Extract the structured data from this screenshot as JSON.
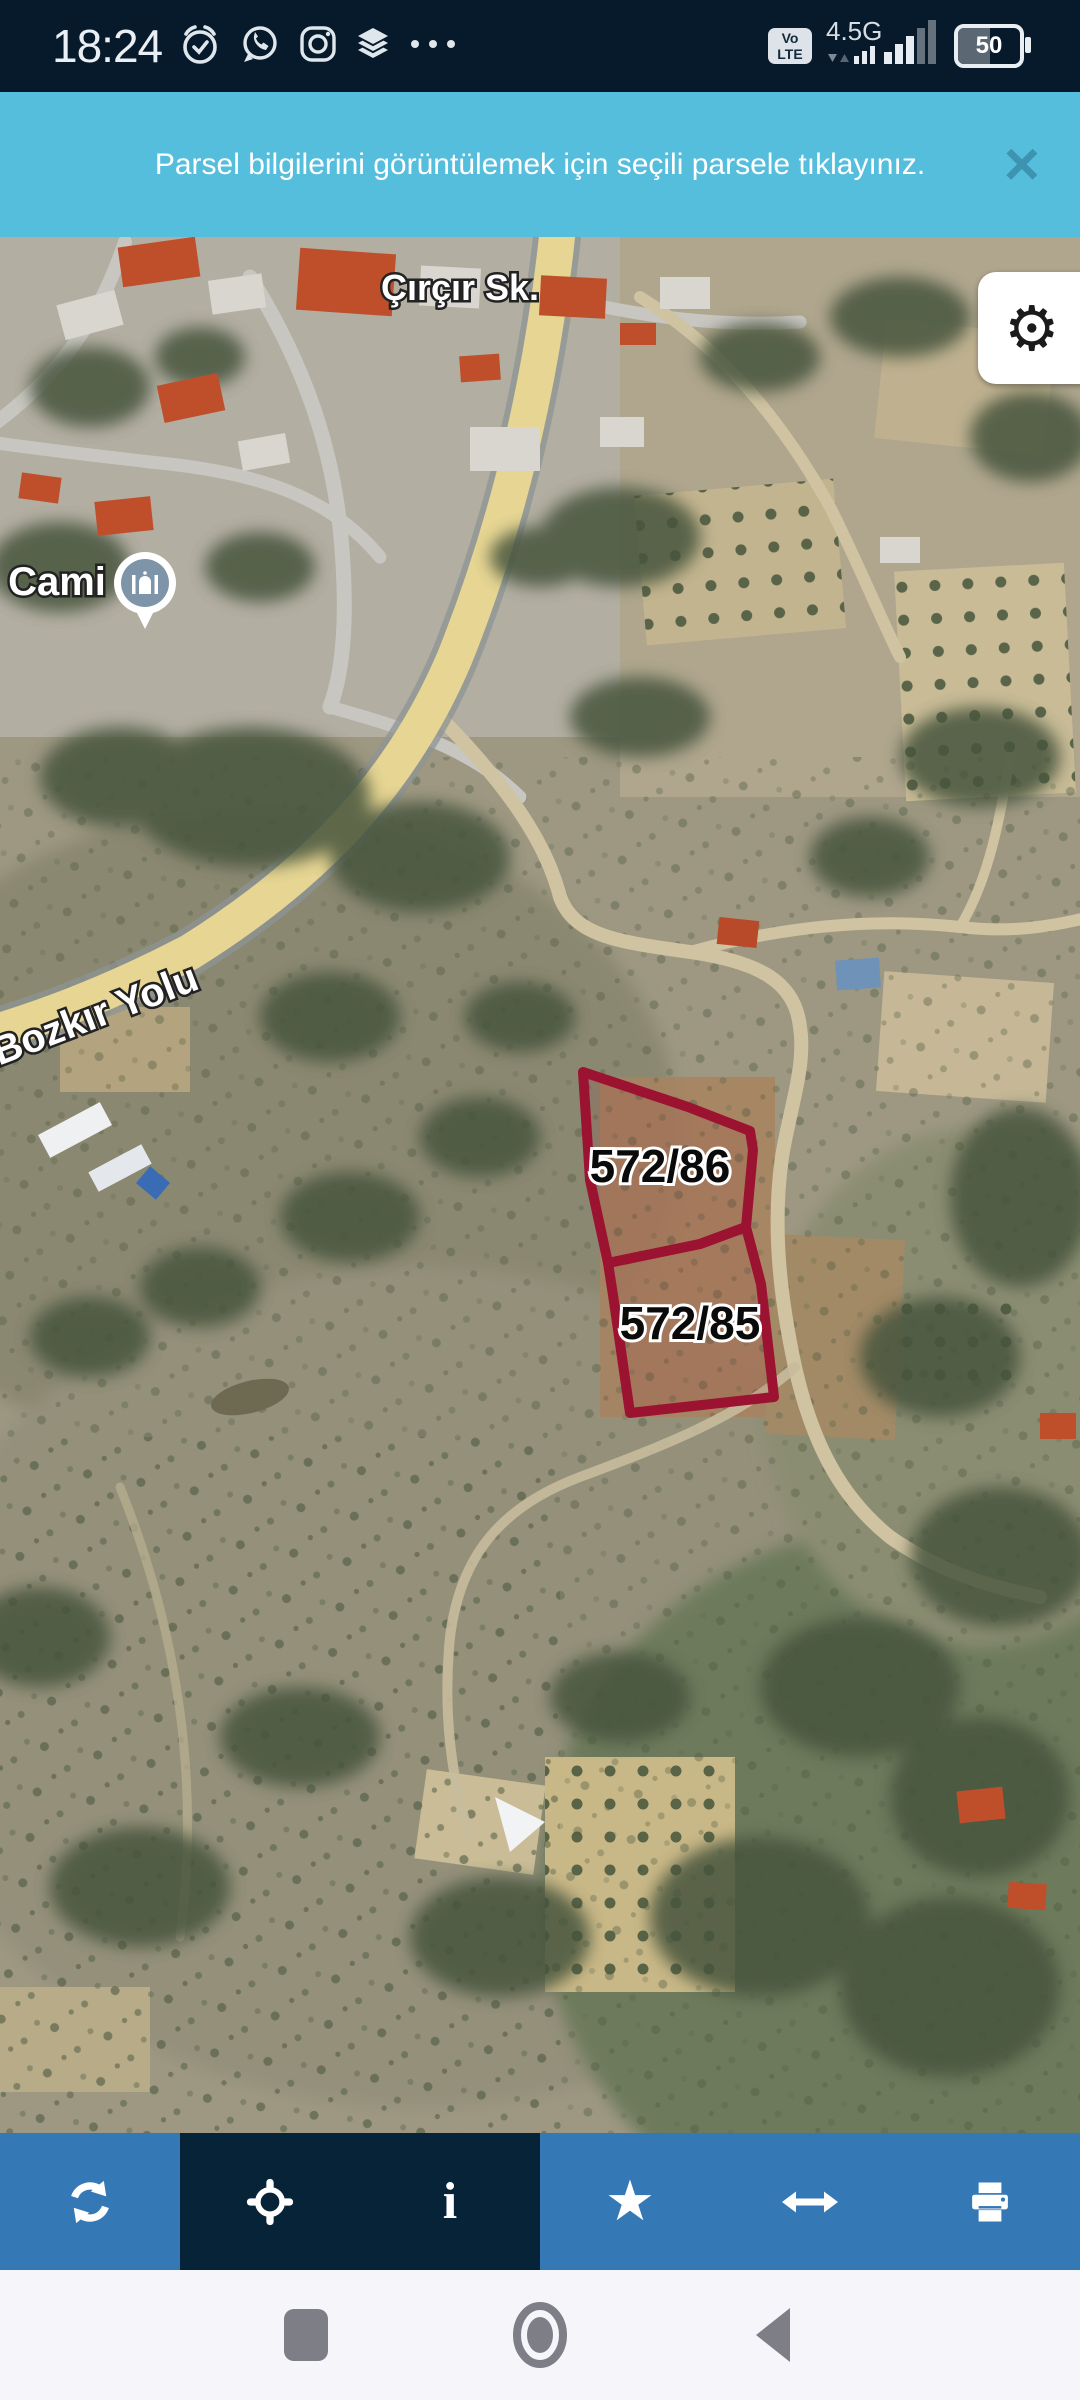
{
  "status_bar": {
    "time": "18:24",
    "left_icons": [
      "alarm",
      "whatsapp",
      "instagram",
      "layers",
      "more"
    ],
    "volte_line1": "Vo",
    "volte_line2": "LTE",
    "network_type": "4.5G",
    "battery_percent": "50"
  },
  "banner": {
    "message": "Parsel bilgilerini görüntülemek için seçili parsele tıklayınız.",
    "close_glyph": "×"
  },
  "map": {
    "street_label": "Çırçır Sk.",
    "poi_label": "Cami",
    "road_label": "Bozkır Yolu",
    "parcels": [
      {
        "id": "572/86"
      },
      {
        "id": "572/85"
      }
    ],
    "settings_glyph": "⚙"
  },
  "toolbar": {
    "buttons": [
      {
        "name": "refresh"
      },
      {
        "name": "locate"
      },
      {
        "name": "info"
      },
      {
        "name": "favorite"
      },
      {
        "name": "measure"
      },
      {
        "name": "print"
      }
    ],
    "info_glyph": "i",
    "star_glyph": "★"
  },
  "nav_bar": {
    "buttons": [
      "recents",
      "home",
      "back"
    ]
  },
  "colors": {
    "banner_bg": "#55bedd",
    "toolbar_blue": "#3478b6",
    "toolbar_dark": "#072338",
    "parcel_outline": "#9b1331",
    "status_bg": "#071a2b"
  }
}
